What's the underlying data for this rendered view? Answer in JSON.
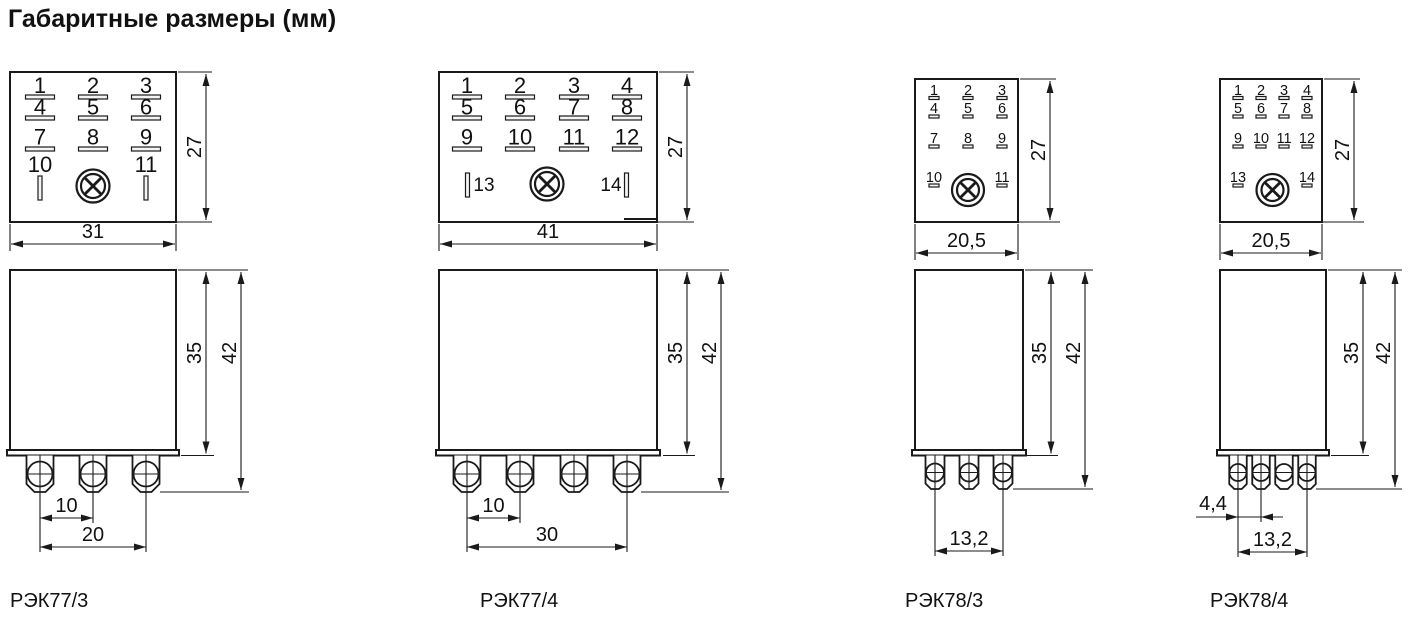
{
  "title": "Габаритные размеры (мм)",
  "ink_color": "#1a1a1a",
  "icons": {
    "indicator_lamp": "circle-with-diagonal-cross",
    "pin_hole": "circle-with-crosshair"
  },
  "diagrams": [
    {
      "model": "РЭК77/3",
      "top": {
        "rows": [
          [
            "1",
            "2",
            "3"
          ],
          [
            "4",
            "5",
            "6"
          ],
          [
            "7",
            "8",
            "9"
          ]
        ],
        "aux": [
          "10",
          "11"
        ],
        "width": "31",
        "height": "27"
      },
      "front": {
        "body_height": "35",
        "total_height": "42",
        "dim1": "10",
        "dim2": "20"
      }
    },
    {
      "model": "РЭК77/4",
      "top": {
        "rows": [
          [
            "1",
            "2",
            "3",
            "4"
          ],
          [
            "5",
            "6",
            "7",
            "8"
          ],
          [
            "9",
            "10",
            "11",
            "12"
          ]
        ],
        "aux": [
          "13",
          "14"
        ],
        "width": "41",
        "height": "27"
      },
      "front": {
        "body_height": "35",
        "total_height": "42",
        "dim1": "10",
        "dim2": "30"
      }
    },
    {
      "model": "РЭК78/3",
      "top": {
        "rows": [
          [
            "1",
            "2",
            "3"
          ],
          [
            "4",
            "5",
            "6"
          ],
          [
            "7",
            "8",
            "9"
          ]
        ],
        "aux": [
          "10",
          "11"
        ],
        "width": "20,5",
        "height": "27"
      },
      "front": {
        "body_height": "35",
        "total_height": "42",
        "dim2": "13,2"
      }
    },
    {
      "model": "РЭК78/4",
      "top": {
        "rows": [
          [
            "1",
            "2",
            "3",
            "4"
          ],
          [
            "5",
            "6",
            "7",
            "8"
          ],
          [
            "9",
            "10",
            "11",
            "12"
          ]
        ],
        "aux": [
          "13",
          "14"
        ],
        "width": "20,5",
        "height": "27"
      },
      "front": {
        "body_height": "35",
        "total_height": "42",
        "dim1": "4,4",
        "dim2": "13,2"
      }
    }
  ]
}
